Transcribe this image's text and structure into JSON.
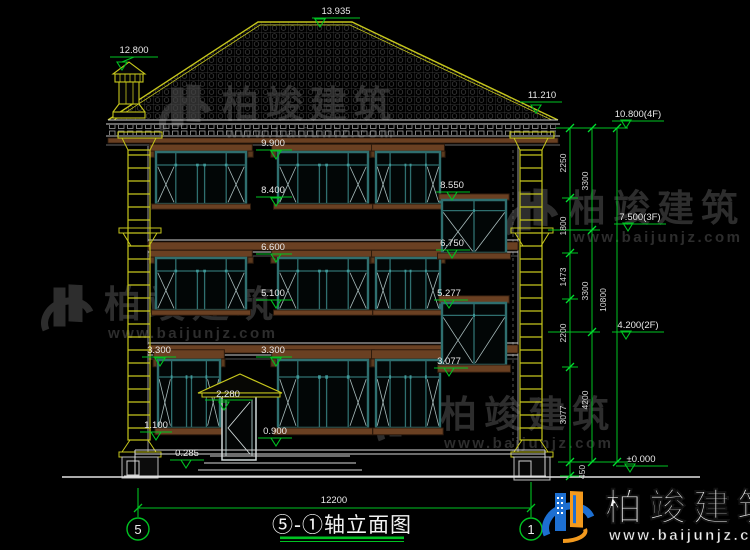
{
  "drawing": {
    "title": "⑤-①轴立面图",
    "axis_left": "5",
    "axis_right": "1",
    "total_width": "12200"
  },
  "elevation_labels": {
    "ridge": "13.935",
    "chimney": "12.800",
    "eave": "11.210",
    "level_4f": "10.800(4F)",
    "level_3f": "7.500(3F)",
    "level_2f": "4.200(2F)",
    "level_zero": "±0.000",
    "f3_win_top": "9.900",
    "f3_win_sill": "8.400",
    "bay3_top": "8.550",
    "bay3_bottom": "6.750",
    "f2_win_top": "6.600",
    "f2_win_sill": "5.100",
    "bay2_top": "5.277",
    "bay2_bottom": "3.077",
    "f1_win_top_left": "3.300",
    "f1_win_top_center": "3.300",
    "door_canopy": "2.280",
    "f1_sill_left": "1.100",
    "f1_sill_center": "0.900",
    "terrace": "0.285"
  },
  "dim_chain_inner": [
    "2250",
    "1800",
    "1473",
    "2200",
    "3077",
    "450"
  ],
  "dim_chain_mid": [
    "3300",
    "3300",
    "4200"
  ],
  "dim_chain_outer": [
    "10800"
  ],
  "watermark": {
    "brand": "柏竣建筑",
    "site": "www.baijunjz.com"
  },
  "colors": {
    "dim_green": "#00c322",
    "cad_yellow": "#c6c61c",
    "window_teal": "#2f6f6f",
    "trim_brown": "#6a4022",
    "logo_blue": "#1d6fd1",
    "logo_orange": "#f2991d"
  }
}
